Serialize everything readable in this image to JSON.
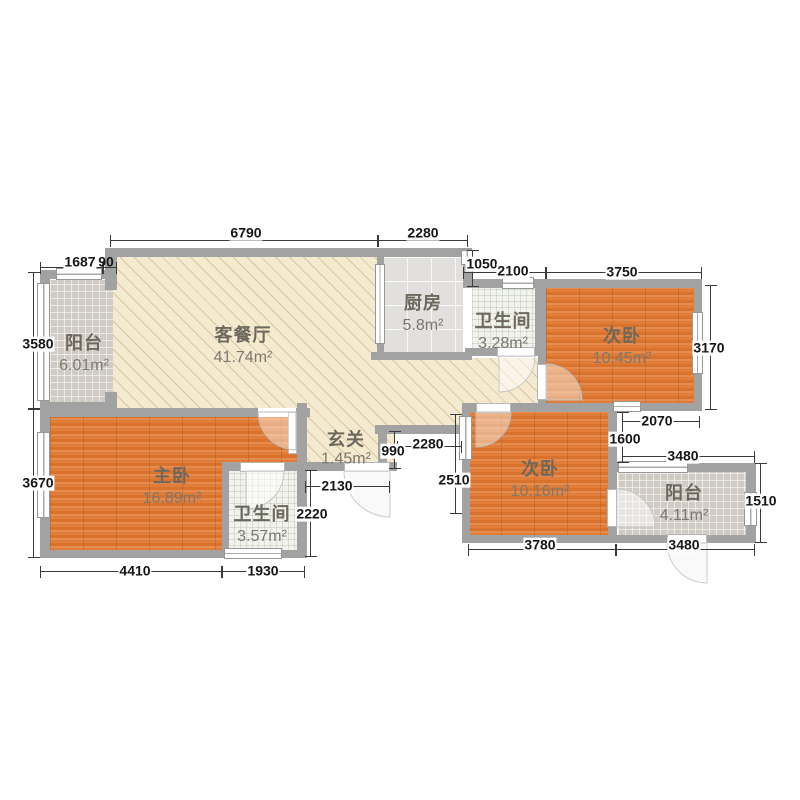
{
  "plan_title": "apartment-floor-plan",
  "rooms": {
    "balcony_left": {
      "name": "阳台",
      "area": "6.01m²"
    },
    "living": {
      "name": "客餐厅",
      "area": "41.74m²"
    },
    "kitchen": {
      "name": "厨房",
      "area": "5.8m²"
    },
    "bath_top": {
      "name": "卫生间",
      "area": "3.28m²"
    },
    "bed_right_top": {
      "name": "次卧",
      "area": "10.45m²"
    },
    "hall": {
      "name": "玄关",
      "area": "1.45m²"
    },
    "master": {
      "name": "主卧",
      "area": "16.89m²"
    },
    "bath_master": {
      "name": "卫生间",
      "area": "3.57m²"
    },
    "bed_right_bottom": {
      "name": "次卧",
      "area": "10.16m²"
    },
    "balcony_right": {
      "name": "阳台",
      "area": "4.11m²"
    }
  },
  "dimensions": {
    "top_living": "6790",
    "top_kitchen": "2280",
    "balcony_a": "1687",
    "balcony_b": "90",
    "step_v": "1050",
    "bath_top_w": "2100",
    "bed1_w": "3750",
    "balcony_left_h": "3580",
    "master_h": "3670",
    "bed1_h": "3170",
    "notch_w": "2070",
    "notch_h": "1600",
    "balcony_right_w_top": "3480",
    "balcony_right_h": "1510",
    "hall_w": "2280",
    "hall_h": "990",
    "hall_bottom_w": "2130",
    "bath_master_h": "2220",
    "bed2_h": "2510",
    "master_w": "4410",
    "bath_master_w": "1930",
    "bed2_w": "3780",
    "balcony_right_w_bottom": "3480"
  },
  "colors": {
    "wall": "#a2a2a2",
    "wood_floor": "#df7e38",
    "living_floor": "#f4ead0",
    "tile_floor": "#d0ccc5",
    "kitchen_floor": "#e1e0de",
    "bath_floor": "#f3f3ee",
    "dimension_text": "#161616",
    "room_text": "#6d685e"
  }
}
